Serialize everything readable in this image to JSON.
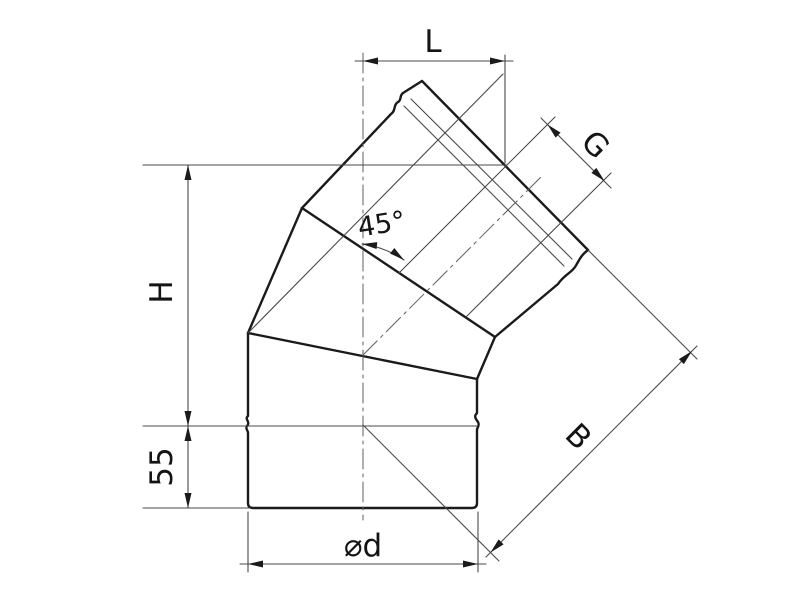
{
  "drawing": {
    "kind_note": "45-degree elbow pipe technical dimension drawing",
    "colors": {
      "outline": "#1b1b1b",
      "thin_line": "#4a4a4a",
      "background": "#ffffff"
    },
    "dimensions": {
      "top_width_label": "L",
      "socket_length_label": "G",
      "height_label": "H",
      "bottom_stub_value": "55",
      "diameter_label": "⌀d",
      "diagonal_length_label": "B",
      "angle_value": "45°"
    }
  }
}
